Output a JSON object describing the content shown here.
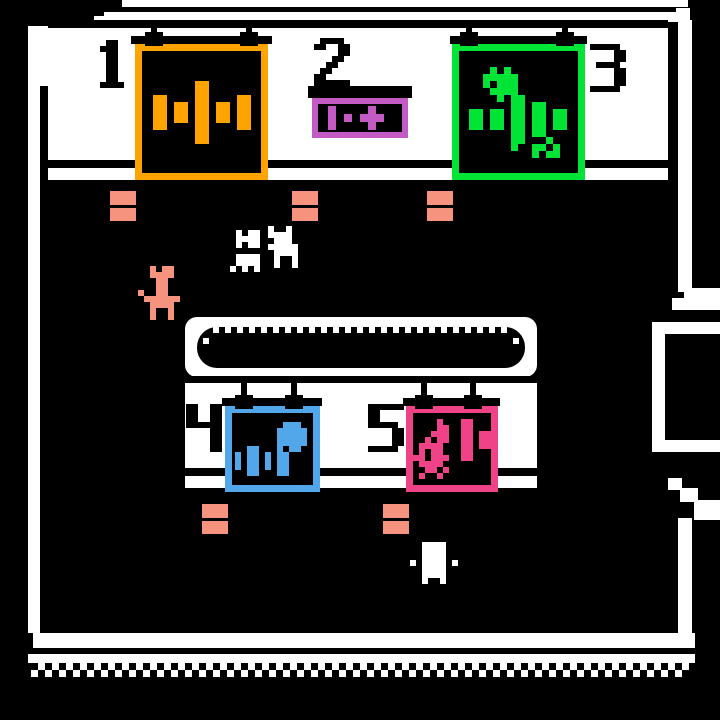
{
  "palette": {
    "black": "#000000",
    "white": "#FFFFFF",
    "orange": "#FFA300",
    "magenta": "#C45BC5",
    "green": "#00E436",
    "blue": "#52A7EA",
    "pink": "#EF4287",
    "salmon": "#F5937F"
  },
  "stations": [
    {
      "label": "1",
      "color": "orange",
      "icon": "dumbbell-icon"
    },
    {
      "label": "2",
      "color": "magenta",
      "icon": "sign-add-weight-icon"
    },
    {
      "label": "3",
      "color": "green",
      "icon": "burst-dumbbell-icon"
    },
    {
      "label": "4",
      "color": "blue",
      "icon": "bars-ball-icon"
    },
    {
      "label": "5",
      "color": "pink",
      "icon": "swirl-dumbbell-icon"
    }
  ],
  "fixtures": {
    "hooks": [
      {
        "cx": 154,
        "y": 20
      },
      {
        "cx": 249,
        "y": 20
      },
      {
        "cx": 469,
        "y": 20
      },
      {
        "cx": 565,
        "y": 20
      },
      {
        "cx": 244,
        "y": 383
      },
      {
        "cx": 294,
        "y": 383
      },
      {
        "cx": 424,
        "y": 383
      },
      {
        "cx": 473,
        "y": 383
      }
    ],
    "benches": [
      {
        "x": 110,
        "y": 191
      },
      {
        "x": 292,
        "y": 191
      },
      {
        "x": 427,
        "y": 191
      },
      {
        "x": 202,
        "y": 504
      },
      {
        "x": 383,
        "y": 504
      }
    ]
  },
  "pixmaps": {
    "digit1": [
      "..##..",
      ".###..",
      "..##..",
      "..##..",
      "..##..",
      "..##..",
      "..##..",
      ".####."
    ],
    "digit2": [
      ".####.",
      "##..##",
      "....##",
      "...##.",
      "..##..",
      ".##...",
      "##....",
      "######"
    ],
    "digit3": [
      "#####.",
      "....##",
      "....##",
      ".####.",
      "....##",
      "....##",
      "....##",
      "#####."
    ],
    "digit4": [
      "##..##",
      "##..##",
      "##..##",
      "######",
      "....##",
      "....##",
      "....##",
      "....##"
    ],
    "digit5": [
      "######",
      "##....",
      "##....",
      "#####.",
      "....##",
      "....##",
      "....##",
      "#####."
    ],
    "dumbbell": [
      "......##......",
      "......##......",
      "##....##....##",
      "##.##.##.##.##",
      "##.##.##.##.##",
      "##.##.##.##.##",
      "##....##....##",
      "......##......",
      "......##......"
    ],
    "burst_dumbbell": [
      "...#.#........",
      "..#####.......",
      "..#.###.......",
      "...####.......",
      "....#.##......",
      "......##.##...",
      "##.##.##.##.##",
      "##.##.##.##.##",
      "##.##.##.##.##",
      "......##.##...",
      "......##...#..",
      "......#..##.#.",
      ".........#.##."
    ],
    "sign_glyphs": [
      "##........##....",
      "##........##....",
      "##..##..######..",
      "##..##..######..",
      "##........##....",
      "##........##...."
    ],
    "bars_ball": [
      "........###.",
      ".......#####",
      ".......#####",
      ".......#####",
      "..##...#o##.",
      "#.##.#.##...",
      "#.##.#.##...",
      "#.##.#.##...",
      "..##...##..."
    ],
    "swirl_dumbbell": [
      "....#...##...",
      "....##..##...",
      "...###..##.##",
      "..#.##..##.##",
      ".####...##.##",
      ".#o##...##...",
      "##.###..##...",
      ".####........",
      "..##.#.......",
      ".#..#........"
    ],
    "critterA": [
      ".#.##",
      ".####",
      ".#.##",
      ".....",
      ".####",
      ".####",
      "#.#.#"
    ],
    "critterB": [
      "#..#.",
      "####.",
      ".###.",
      "#####",
      ".####",
      ".#..#",
      ".#..#"
    ],
    "goat": [
      "..#.##..",
      "..####..",
      "...##...",
      "...##...",
      "#..##...",
      ".######.",
      "..####..",
      "..#..#..",
      "..#..#.."
    ],
    "critterC": [
      "..####..",
      "..####..",
      "..####..",
      "#.####.#",
      "..####..",
      "..####..",
      "..#..#.."
    ]
  },
  "sprites": [
    {
      "name": "station-1-number",
      "map": "digit1",
      "color": "black",
      "x": 94,
      "y": 40,
      "cell": 6,
      "interactable": false
    },
    {
      "name": "station-2-number",
      "map": "digit2",
      "color": "black",
      "x": 314,
      "y": 38,
      "cell": 6,
      "interactable": false
    },
    {
      "name": "station-3-number",
      "map": "digit3",
      "color": "black",
      "x": 590,
      "y": 44,
      "cell": 6,
      "interactable": false
    },
    {
      "name": "station-4-number",
      "map": "digit4",
      "color": "black",
      "x": 186,
      "y": 404,
      "cell": 6,
      "interactable": false
    },
    {
      "name": "station-5-number",
      "map": "digit5",
      "color": "black",
      "x": 368,
      "y": 404,
      "cell": 6,
      "interactable": false
    },
    {
      "name": "dumbbell-icon",
      "map": "dumbbell",
      "color": "orange",
      "x": 153,
      "y": 81,
      "cell": 7,
      "interactable": false
    },
    {
      "name": "sign-add-weight-icon",
      "map": "sign_glyphs",
      "color": "magenta",
      "x": 328,
      "y": 106,
      "cell": 4,
      "interactable": false
    },
    {
      "name": "burst-dumbbell-icon",
      "map": "burst_dumbbell",
      "color": "green",
      "x": 469,
      "y": 67,
      "cell": 7,
      "interactable": false
    },
    {
      "name": "bars-ball-icon",
      "map": "bars_ball",
      "color": "blue",
      "x": 235,
      "y": 422,
      "cell": 6,
      "interactable": false
    },
    {
      "name": "swirl-dumbbell-icon",
      "map": "swirl_dumbbell",
      "color": "pink",
      "x": 413,
      "y": 419,
      "cell": 6,
      "interactable": false
    },
    {
      "name": "creature-white-a",
      "map": "critterA",
      "color": "white",
      "x": 230,
      "y": 230,
      "cell": 6,
      "interactable": true
    },
    {
      "name": "creature-white-b",
      "map": "critterB",
      "color": "white",
      "x": 268,
      "y": 226,
      "cell": 6,
      "interactable": true
    },
    {
      "name": "creature-salmon-goat",
      "map": "goat",
      "color": "salmon",
      "x": 138,
      "y": 266,
      "cell": 6,
      "interactable": true
    },
    {
      "name": "creature-white-c",
      "map": "critterC",
      "color": "white",
      "x": 410,
      "y": 542,
      "cell": 6,
      "interactable": true
    }
  ]
}
